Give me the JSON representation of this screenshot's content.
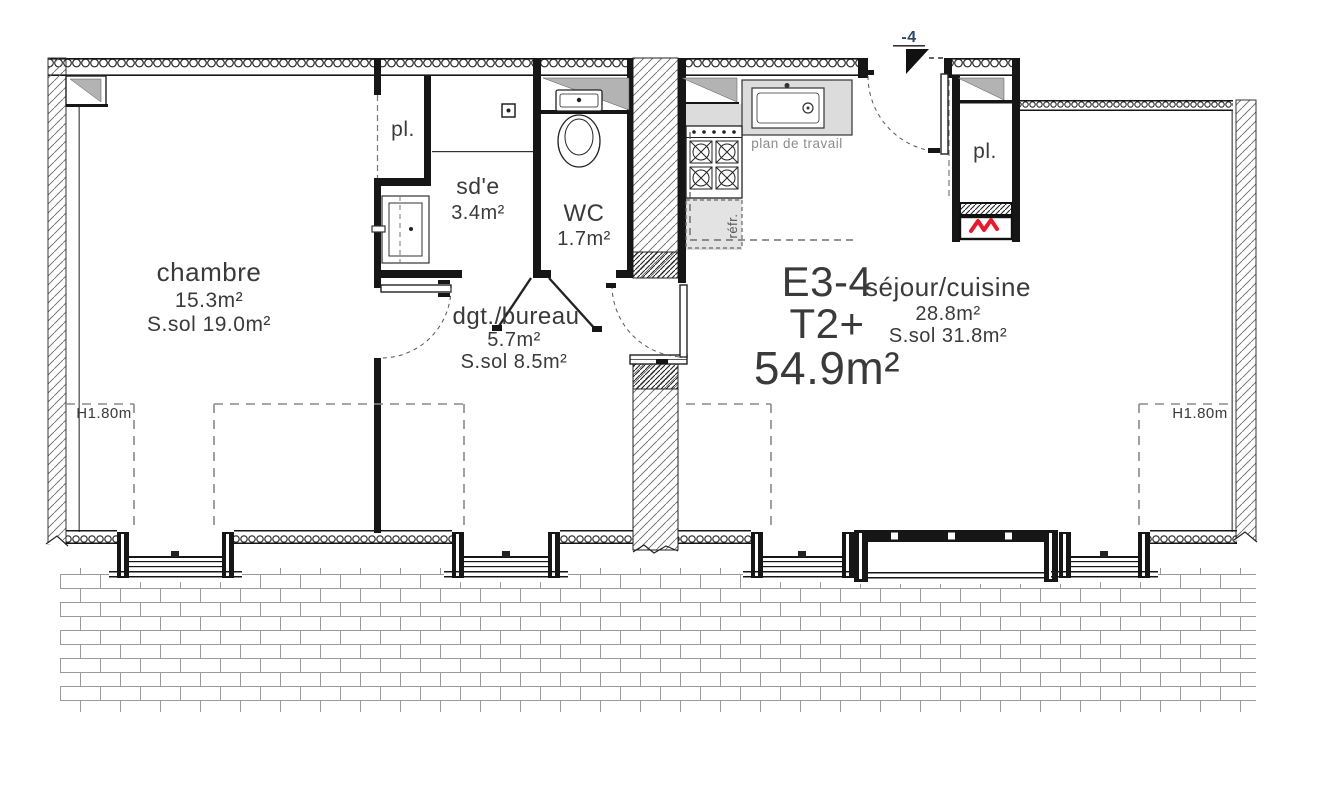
{
  "unit": {
    "code": "E3-4",
    "type": "T2+",
    "total_area": "54.9m²"
  },
  "rooms": {
    "chambre": {
      "name": "chambre",
      "area": "15.3m²",
      "floor": "S.sol 19.0m²"
    },
    "sde": {
      "name": "sd'e",
      "area": "3.4m²"
    },
    "wc": {
      "name": "WC",
      "area": "1.7m²"
    },
    "dgt": {
      "name": "dgt./bureau",
      "area": "5.7m²",
      "floor": "S.sol 8.5m²"
    },
    "sejour": {
      "name": "séjour/cuisine",
      "area": "28.8m²",
      "floor": "S.sol 31.8m²"
    },
    "closet_left": {
      "name": "pl."
    },
    "closet_right": {
      "name": "pl."
    }
  },
  "annotations": {
    "worktop": "plan de travail",
    "fridge": "réfr.",
    "ceiling_height_left": "H1.80m",
    "ceiling_height_right": "H1.80m",
    "entry_level": "-4"
  },
  "colors": {
    "line": "#161616",
    "text": "#3a3a3a",
    "muted_text": "#8c8c8c",
    "entry_marker_blue": "#2d4569",
    "duct_gray": "#b3b3b3",
    "counter_gray": "#dcdcdc",
    "heater_red": "#e8192c"
  }
}
